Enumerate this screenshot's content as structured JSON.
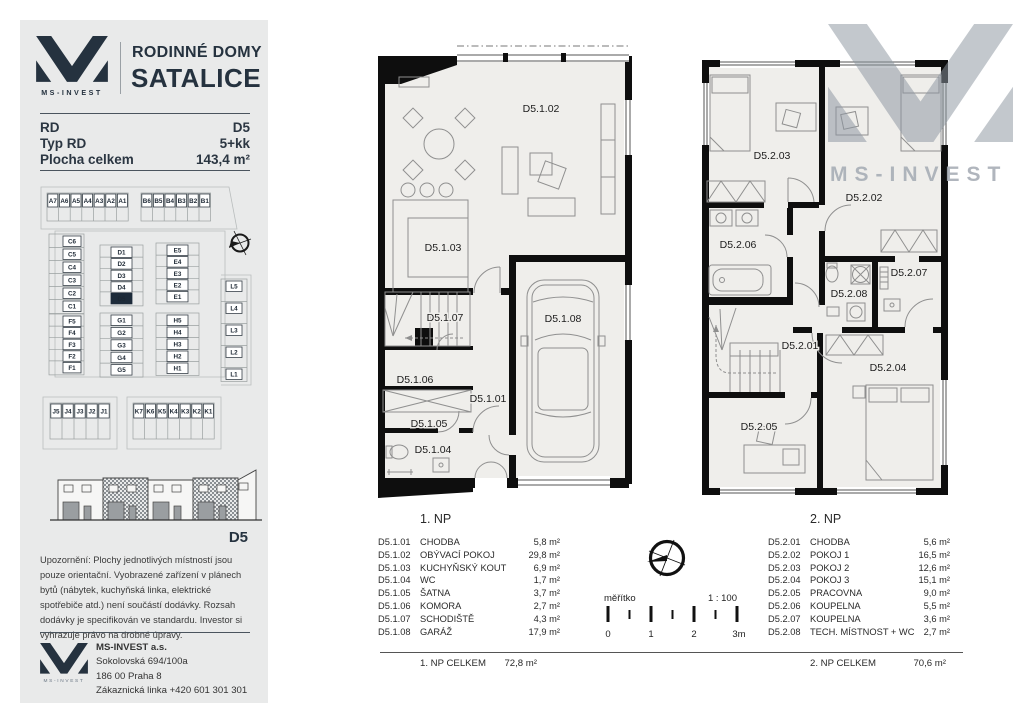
{
  "brand": {
    "name": "MS-INVEST",
    "title_line1": "RODINNÉ DOMY",
    "title_line2": "SATALICE"
  },
  "info": {
    "rows": [
      {
        "label": "RD",
        "value": "D5"
      },
      {
        "label": "Typ RD",
        "value": "5+kk"
      },
      {
        "label": "Plocha celkem",
        "value": "143,4 m²"
      }
    ]
  },
  "site_plan": {
    "highlight": "D5",
    "groups": [
      {
        "labels": [
          "A7",
          "A6",
          "A5",
          "A4",
          "A3",
          "A2",
          "A1"
        ]
      },
      {
        "labels": [
          "B6",
          "B5",
          "B4",
          "B3",
          "B2",
          "B1"
        ]
      },
      {
        "labels": [
          "C6",
          "C5",
          "C4",
          "C3",
          "C2",
          "C1"
        ]
      },
      {
        "labels": [
          "D1",
          "D2",
          "D3",
          "D4",
          "D5"
        ]
      },
      {
        "labels": [
          "E5",
          "E4",
          "E3",
          "E2",
          "E1"
        ]
      },
      {
        "labels": [
          "L5",
          "L4",
          "L3",
          "L2",
          "L1"
        ]
      },
      {
        "labels": [
          "F5",
          "F4",
          "F3",
          "F2",
          "F1"
        ]
      },
      {
        "labels": [
          "G1",
          "G2",
          "G3",
          "G4",
          "G5"
        ]
      },
      {
        "labels": [
          "H5",
          "H4",
          "H3",
          "H2",
          "H1"
        ]
      },
      {
        "labels": [
          "J5",
          "J4",
          "J3",
          "J2",
          "J1"
        ]
      },
      {
        "labels": [
          "K7",
          "K6",
          "K5",
          "K4",
          "K3",
          "K2",
          "K1"
        ]
      }
    ]
  },
  "elevation": {
    "label": "D5"
  },
  "disclaimer": "Upozornění: Plochy jednotlivých místností jsou pouze orientační. Vyobrazené zařízení v plánech bytů (nábytek, kuchyňská linka, elektrické spotřebiče atd.) není součástí dodávky. Rozsah dodávky je specifikován ve standardu. Investor si vyhrazuje právo na drobné úpravy.",
  "footer": {
    "company": "MS-INVEST a.s.",
    "address1": "Sokolovská 694/100a",
    "address2": "186 00 Praha 8",
    "phone": "Zákaznická linka +420 601 301 301"
  },
  "plans": {
    "floor1": {
      "rooms": {
        "r01": "D5.1.01",
        "r02": "D5.1.02",
        "r03": "D5.1.03",
        "r04": "D5.1.04",
        "r05": "D5.1.05",
        "r06": "D5.1.06",
        "r07": "D5.1.07",
        "r08": "D5.1.08"
      }
    },
    "floor2": {
      "rooms": {
        "r01": "D5.2.01",
        "r02": "D5.2.02",
        "r03": "D5.2.03",
        "r04": "D5.2.04",
        "r05": "D5.2.05",
        "r06": "D5.2.06",
        "r07": "D5.2.07",
        "r08": "D5.2.08"
      }
    }
  },
  "legends": [
    {
      "title": "1. NP",
      "rows": [
        {
          "code": "D5.1.01",
          "name": "CHODBA",
          "area": "5,8 m²"
        },
        {
          "code": "D5.1.02",
          "name": "OBÝVACÍ POKOJ",
          "area": "29,8 m²"
        },
        {
          "code": "D5.1.03",
          "name": "KUCHYŇSKÝ KOUT",
          "area": "6,9 m²"
        },
        {
          "code": "D5.1.04",
          "name": "WC",
          "area": "1,7 m²"
        },
        {
          "code": "D5.1.05",
          "name": "ŠATNA",
          "area": "3,7 m²"
        },
        {
          "code": "D5.1.06",
          "name": "KOMORA",
          "area": "2,7 m²"
        },
        {
          "code": "D5.1.07",
          "name": "SCHODIŠTĚ",
          "area": "4,3 m²"
        },
        {
          "code": "D5.1.08",
          "name": "GARÁŽ",
          "area": "17,9 m²"
        }
      ],
      "total_label": "1. NP CELKEM",
      "total_value": "72,8 m²"
    },
    {
      "title": "2. NP",
      "rows": [
        {
          "code": "D5.2.01",
          "name": "CHODBA",
          "area": "5,6 m²"
        },
        {
          "code": "D5.2.02",
          "name": "POKOJ 1",
          "area": "16,5 m²"
        },
        {
          "code": "D5.2.03",
          "name": "POKOJ 2",
          "area": "12,6 m²"
        },
        {
          "code": "D5.2.04",
          "name": "POKOJ 3",
          "area": "15,1 m²"
        },
        {
          "code": "D5.2.05",
          "name": "PRACOVNA",
          "area": "9,0 m²"
        },
        {
          "code": "D5.2.06",
          "name": "KOUPELNA",
          "area": "5,5 m²"
        },
        {
          "code": "D5.2.07",
          "name": "KOUPELNA",
          "area": "3,6 m²"
        },
        {
          "code": "D5.2.08",
          "name": "TECH. MÍSTNOST + WC",
          "area": "2,7 m²"
        }
      ],
      "total_label": "2. NP CELKEM",
      "total_value": "70,6 m²"
    }
  ],
  "scalebar": {
    "label": "měřítko",
    "ratio": "1 : 100",
    "ticks": [
      "0",
      "1",
      "2",
      "3m"
    ]
  },
  "watermark": {
    "text": "MS-INVEST"
  },
  "colors": {
    "navy": "#25323f",
    "sidebar_bg": "#e9eaea",
    "highlight": "#1d2b3a",
    "watermark": "#8d96a1"
  }
}
